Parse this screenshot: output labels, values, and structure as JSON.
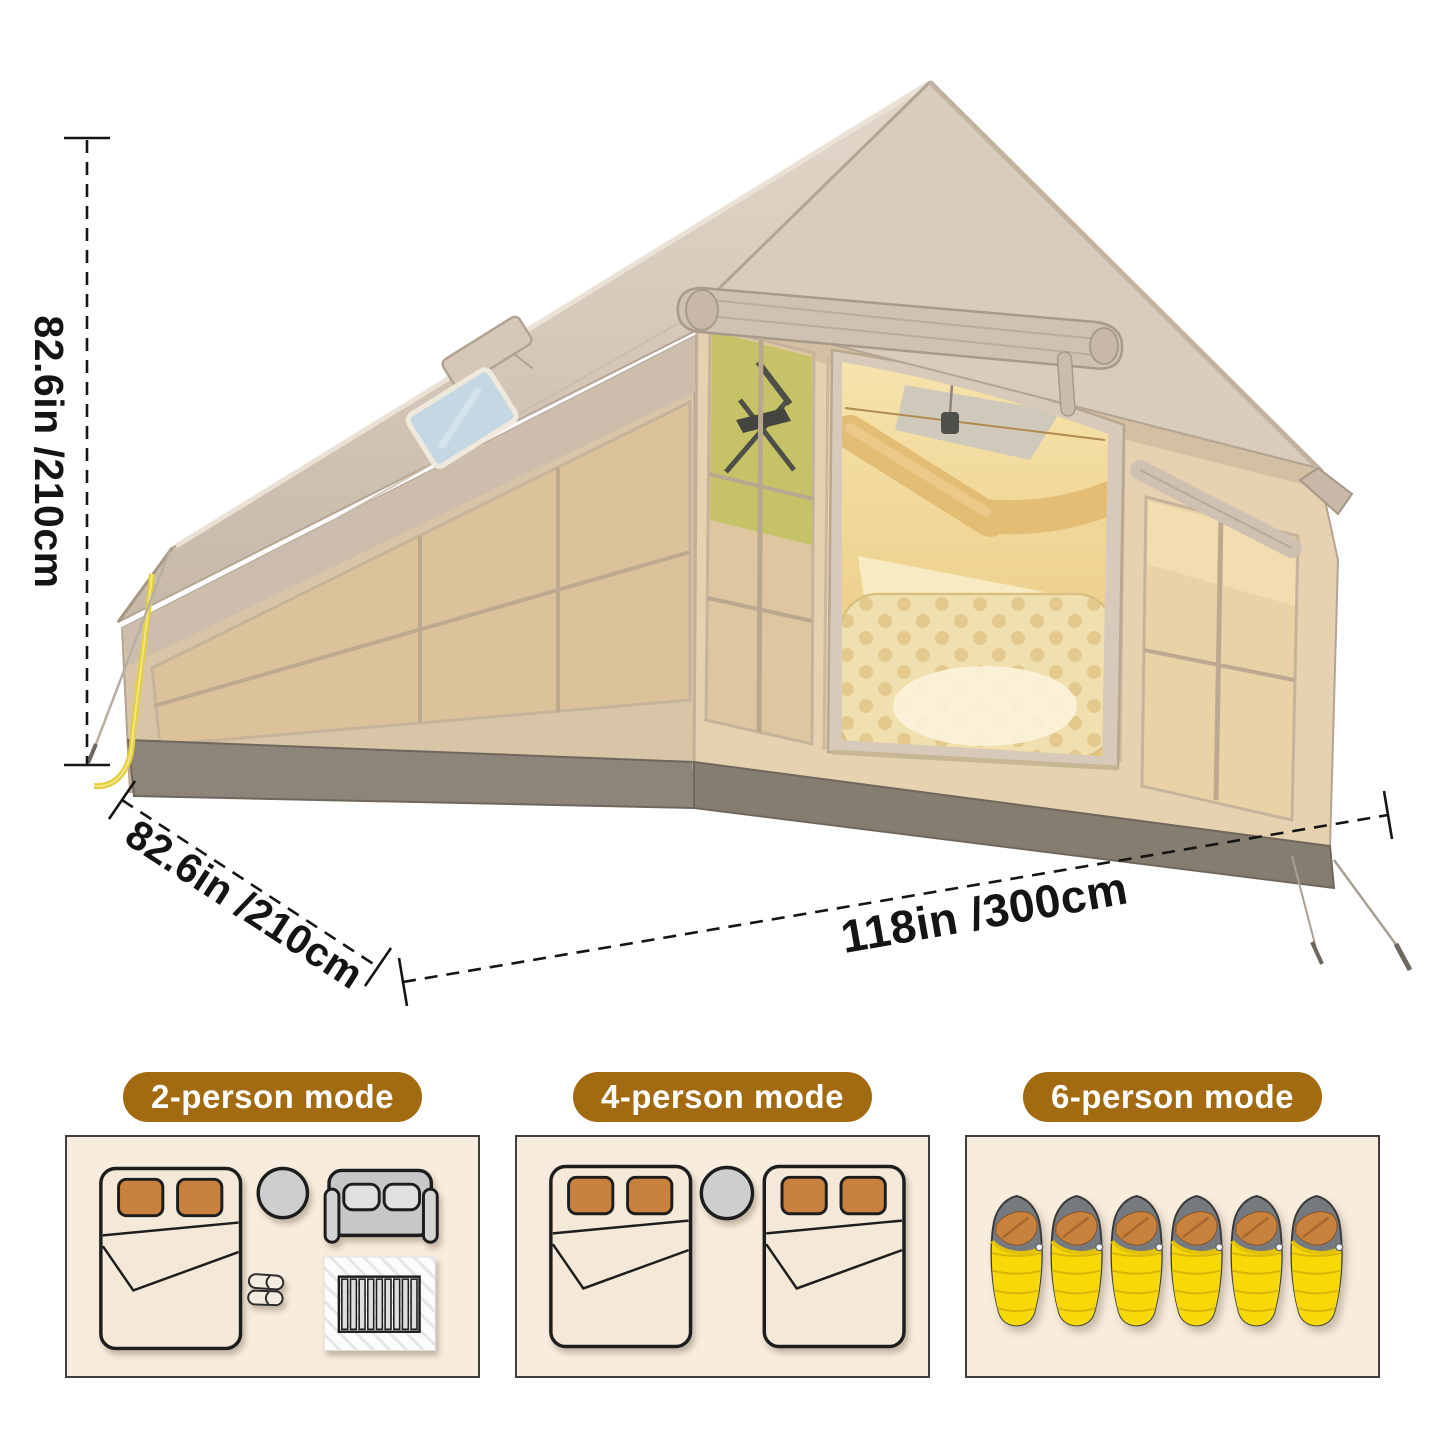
{
  "product": {
    "name": "Inflatable cabin glamping tent",
    "dimensions": {
      "height": "82.6in /210cm",
      "depth": "82.6in /210cm",
      "length": "118in /300cm"
    }
  },
  "modes": [
    {
      "label": "2-person mode",
      "furniture": [
        "double-bed",
        "round-table",
        "sofa",
        "slippers",
        "rug"
      ]
    },
    {
      "label": "4-person mode",
      "furniture": [
        "double-bed",
        "round-table",
        "double-bed"
      ]
    },
    {
      "label": "6-person mode",
      "furniture": [
        "sleeping-bag"
      ],
      "sleeping_bag_count": 6
    }
  ],
  "colors": {
    "badge_brown": "#A26B12",
    "badge_text": "#FFFFFF",
    "panel_cream": "#F7ECDD",
    "panel_border": "#3F3F3F",
    "dimension_text": "#141414",
    "bed_cream": "#F4E9D8",
    "pillow_orange": "#C9813F",
    "table_gray": "#CECECE",
    "sofa_gray": "#C7C7C7",
    "sleeping_bag_yellow": "#F8D908",
    "sleeping_bag_hood_gray": "#76797E",
    "sleeping_bag_flap_orange": "#C8823E",
    "tent_canvas_beige": "#D3C5B5",
    "tent_interior_gold": "#EAC87F",
    "tent_skirt_gray": "#8B8278",
    "skylight_blue": "#C5D7E2",
    "zipper_tassel_yellow": "#E2CE3F"
  }
}
